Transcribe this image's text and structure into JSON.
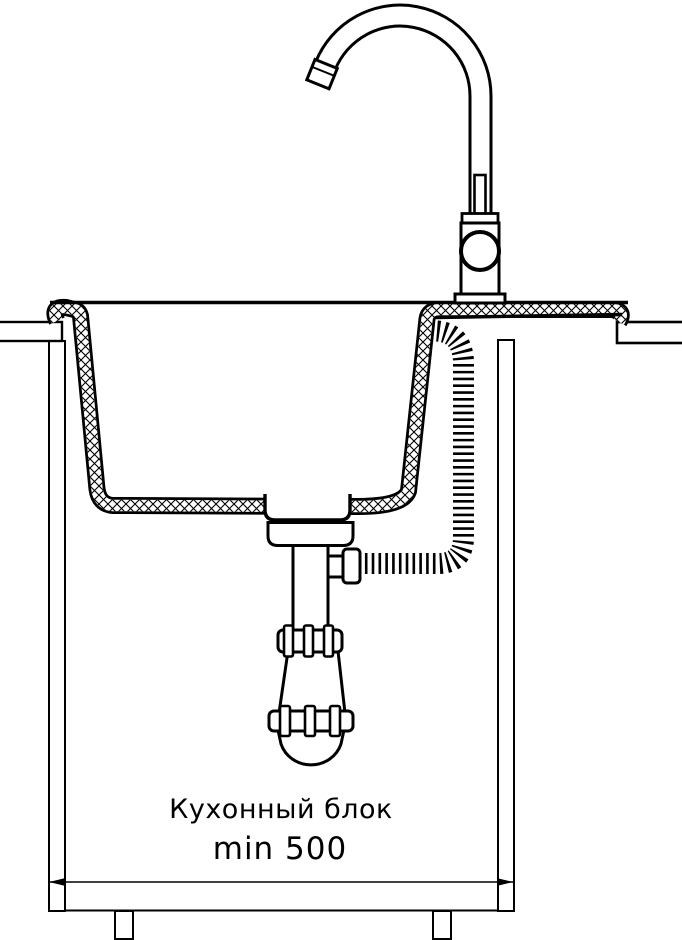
{
  "diagram": {
    "kind": "kitchen-sink-installation-cross-section",
    "labels": {
      "cabinet_block": "Кухонный блок",
      "min_width": "min 500"
    },
    "colors": {
      "line": "#000000",
      "background": "#ffffff"
    },
    "parts": {
      "faucet": "high-arc mixer tap",
      "sink": "cross-hatched sink bowl section",
      "hose": "flexible corrugated hose",
      "trap": "bottle siphon with couplings",
      "cabinet": "kitchen cabinet carcass with feet",
      "dimension": "overall width dimension line"
    }
  }
}
